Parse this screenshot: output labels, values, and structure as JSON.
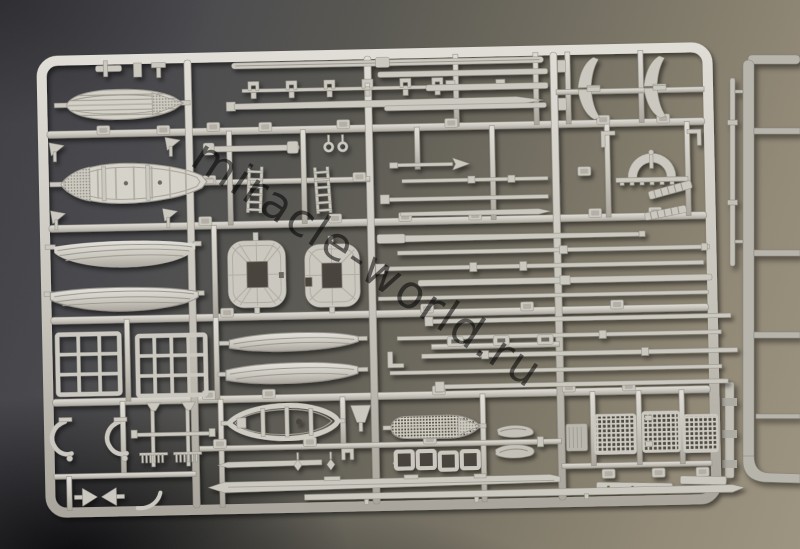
{
  "scene": {
    "subject": "injection-molded-model-kit-sprue-photo"
  },
  "watermark": {
    "text": "miracle-world.ru"
  },
  "colors": {
    "bg_top": "#3e3e43",
    "bg_warm": "#9d9480",
    "plastic": "#cbc8c0",
    "plastic_hi": "#e7e5df",
    "plastic_lo": "#a7a39a",
    "sprue_back": "#b7b4ab",
    "hole_dark": "#46433b",
    "table_mid": "#7d7769",
    "watermark_color": "#1e1e1e"
  },
  "parts": [
    "boat-grating-cover",
    "ribbed-lifeboat",
    "hull-half-upper",
    "hull-half-lower",
    "window-grid-1",
    "window-grid-2",
    "davit-hooks",
    "comb-shafts",
    "bowtie-clamp",
    "yard-spar",
    "tapered-spar",
    "rigging-clamps",
    "fitted-bar",
    "ladder-1",
    "ladder-2",
    "arrow-rod",
    "round-rods",
    "arch-bridge",
    "ladder-ramp-1",
    "ladder-ramp-2",
    "davit-gussets",
    "top-platform-1",
    "top-platform-2",
    "gun-barrels",
    "small-hull-half-1",
    "small-hull-half-2",
    "open-boat",
    "grating-deck-boat",
    "hatch-coamings",
    "figure-parts",
    "ribbed-plate",
    "mesh-grating-1",
    "mesh-grating-2",
    "mesh-grating-3",
    "deck-strip-a",
    "deck-strip-b",
    "anchor-pendants",
    "background-sprue"
  ]
}
